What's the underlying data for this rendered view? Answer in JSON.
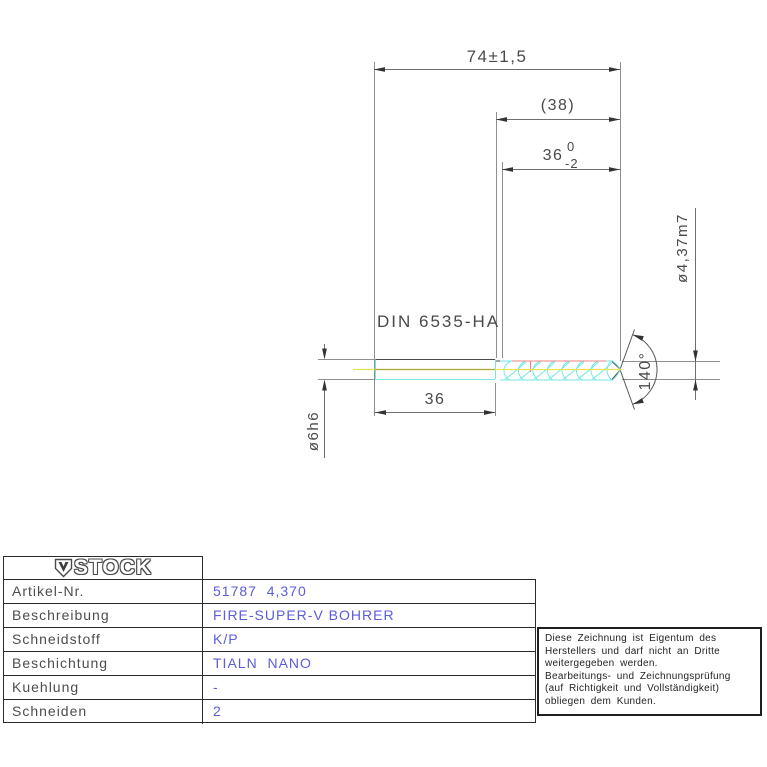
{
  "drawing": {
    "standard_label": "DIN 6535-HA",
    "dimensions": {
      "overall_length": "74±1,5",
      "flute_length_ref": "(38)",
      "flute_length": "36",
      "flute_length_tol_upper": "0",
      "flute_length_tol_lower": "-2",
      "shank_length": "36",
      "shank_diameter": "ø6h6",
      "cutting_diameter": "ø4,37m7",
      "point_angle": "140°"
    },
    "colors": {
      "outline_cyan": "#74e6e6",
      "centerline_yellow": "#e9e34f",
      "centerline_olive": "#a8a845",
      "edge_red": "#f08080",
      "annotation_blue": "#6363dc"
    }
  },
  "title_block": {
    "logo_text": "STOCK",
    "rows": [
      {
        "label": "Artikel-Nr.",
        "value": "51787  4,370"
      },
      {
        "label": "Beschreibung",
        "value": "FIRE-SUPER-V BOHRER"
      },
      {
        "label": "Schneidstoff",
        "value": "K/P"
      },
      {
        "label": "Beschichtung",
        "value": "TIALN  NANO"
      },
      {
        "label": "Kuehlung",
        "value": "-"
      },
      {
        "label": "Schneiden",
        "value": "2"
      }
    ]
  },
  "note_box": {
    "lines": [
      "Diese Zeichnung ist Eigentum des",
      "Herstellers und darf nicht an Dritte",
      "weitergegeben werden.",
      "Bearbeitungs- und Zeichnungsprüfung",
      "(auf Richtigkeit und Vollständigkeit)",
      "obliegen dem Kunden."
    ]
  }
}
